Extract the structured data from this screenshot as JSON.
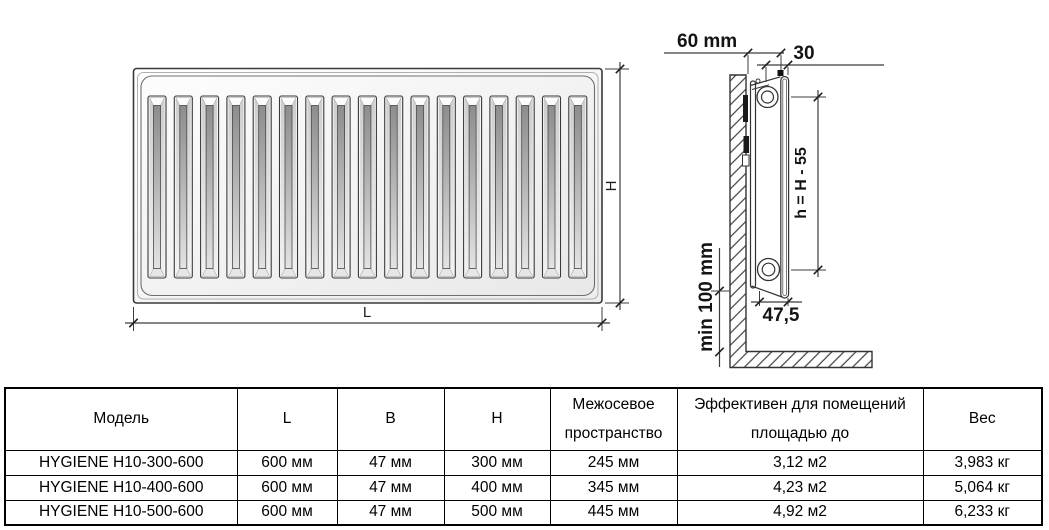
{
  "diagrams": {
    "front_view": {
      "length_label": "L",
      "height_label": "H"
    },
    "side_view": {
      "wall_offset_label": "60 mm",
      "bracket_offset_label": "30",
      "panel_height_label": "h = H - 55",
      "floor_clearance_label": "min 100 mm",
      "depth_label": "47,5"
    }
  },
  "table": {
    "headers": {
      "model": "Модель",
      "length": "L",
      "width": "B",
      "height": "H",
      "spacing_line1": "Межосевое",
      "spacing_line2": "пространство",
      "effective_line1": "Эффективен для помещений",
      "effective_line2": "площадью до",
      "weight": "Вес"
    },
    "rows": [
      {
        "model": "HYGIENE H10-300-600",
        "length": "600 мм",
        "width": "47 мм",
        "height": "300 мм",
        "spacing": "245 мм",
        "area": "3,12 м2",
        "weight": "3,983 кг"
      },
      {
        "model": "HYGIENE H10-400-600",
        "length": "600 мм",
        "width": "47 мм",
        "height": "400 мм",
        "spacing": "345 мм",
        "area": "4,23 м2",
        "weight": "5,064 кг"
      },
      {
        "model": "HYGIENE H10-500-600",
        "length": "600 мм",
        "width": "47 мм",
        "height": "500 мм",
        "spacing": "445 мм",
        "area": "4,92 м2",
        "weight": "6,233 кг"
      }
    ]
  }
}
